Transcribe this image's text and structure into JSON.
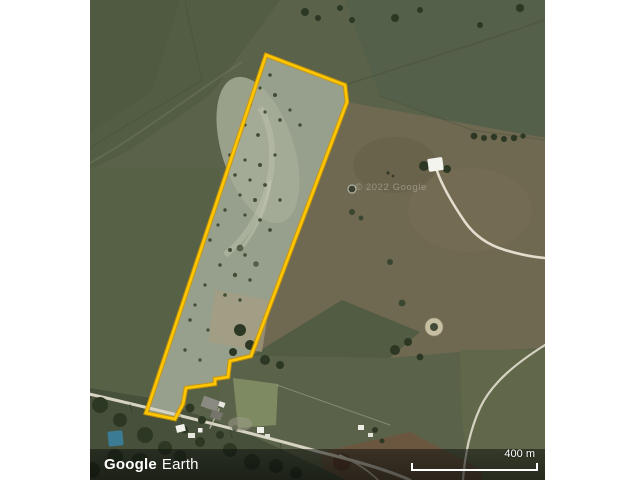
{
  "brand": {
    "google": "Google",
    "earth": "Earth"
  },
  "watermark": {
    "text": "© 2022 Google"
  },
  "scale_bar": {
    "label": "400 m"
  },
  "parcel": {
    "outline_color": "#ffc702",
    "outline_shadow": "#cf9400"
  }
}
